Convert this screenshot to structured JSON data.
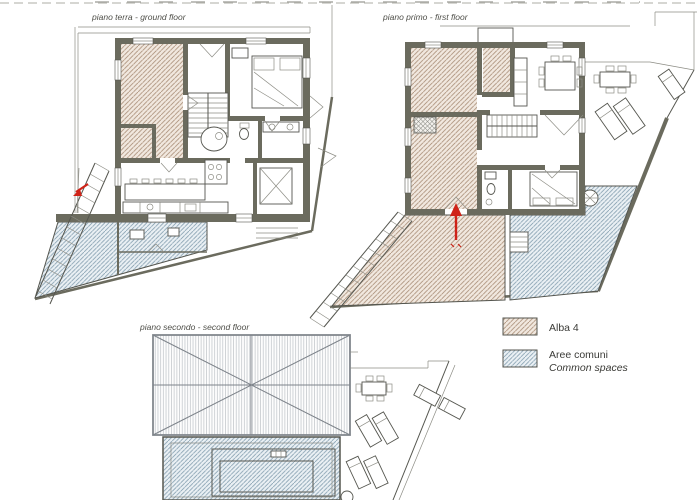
{
  "document": {
    "type": "architectural-floor-plans",
    "building_name": "Alba 4"
  },
  "colors": {
    "background": "#ffffff",
    "wall": "#6b6b5e",
    "line": "#55564f",
    "thin_line": "#8d8d85",
    "alba_fill": "#f1e8df",
    "alba_line": "#ab907a",
    "common_fill": "#eaf0f4",
    "common_line": "#859fb0",
    "roof_line": "#c2c6cb",
    "roof_border": "#83888e",
    "red_marker": "#cf2318",
    "label_text": "#4f4f49"
  },
  "plans": [
    {
      "id": "ground",
      "label": "piano terra - ground floor"
    },
    {
      "id": "first",
      "label": "piano primo - first floor"
    },
    {
      "id": "second",
      "label": "piano secondo - second floor"
    }
  ],
  "legend": {
    "items": [
      {
        "label": "Alba 4",
        "sublabel": "",
        "pattern": "alba-hatch"
      },
      {
        "label": "Aree comuni",
        "sublabel": "Common spaces",
        "pattern": "common-hatch"
      }
    ]
  }
}
